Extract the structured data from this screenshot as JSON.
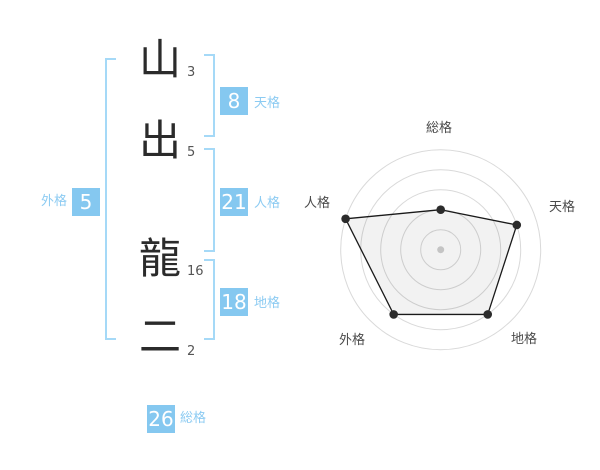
{
  "name_analysis": {
    "characters": [
      {
        "char": "山",
        "strokes": "3"
      },
      {
        "char": "出",
        "strokes": "5"
      },
      {
        "char": "龍",
        "strokes": "16"
      },
      {
        "char": "二",
        "strokes": "2"
      }
    ],
    "kaku": {
      "tenkaku": {
        "label": "天格",
        "value": "8"
      },
      "jinkaku": {
        "label": "人格",
        "value": "21"
      },
      "chikaku": {
        "label": "地格",
        "value": "18"
      },
      "gaikaku": {
        "label": "外格",
        "value": "5"
      },
      "soukaku": {
        "label": "総格",
        "value": "26"
      }
    },
    "badge_color": "#85c8f0",
    "bracket_color": "#a5d9f7",
    "label_color": "#8ccbf2"
  },
  "chart_data": {
    "type": "radar",
    "categories": [
      "総格",
      "天格",
      "地格",
      "外格",
      "人格"
    ],
    "values": [
      2,
      4,
      4,
      4,
      5
    ],
    "max": 5,
    "rings": 5,
    "start_angle_deg": 90,
    "direction": "clockwise",
    "outer_radius_px": 100,
    "grid_color": "#d9d9d9",
    "line_color": "#1a1a1a",
    "fill_color": "rgba(0,0,0,0.05)",
    "point_color": "#2b2b2b",
    "center_dot_color": "#c4c4c4",
    "legend": "none",
    "grid": "circular"
  }
}
